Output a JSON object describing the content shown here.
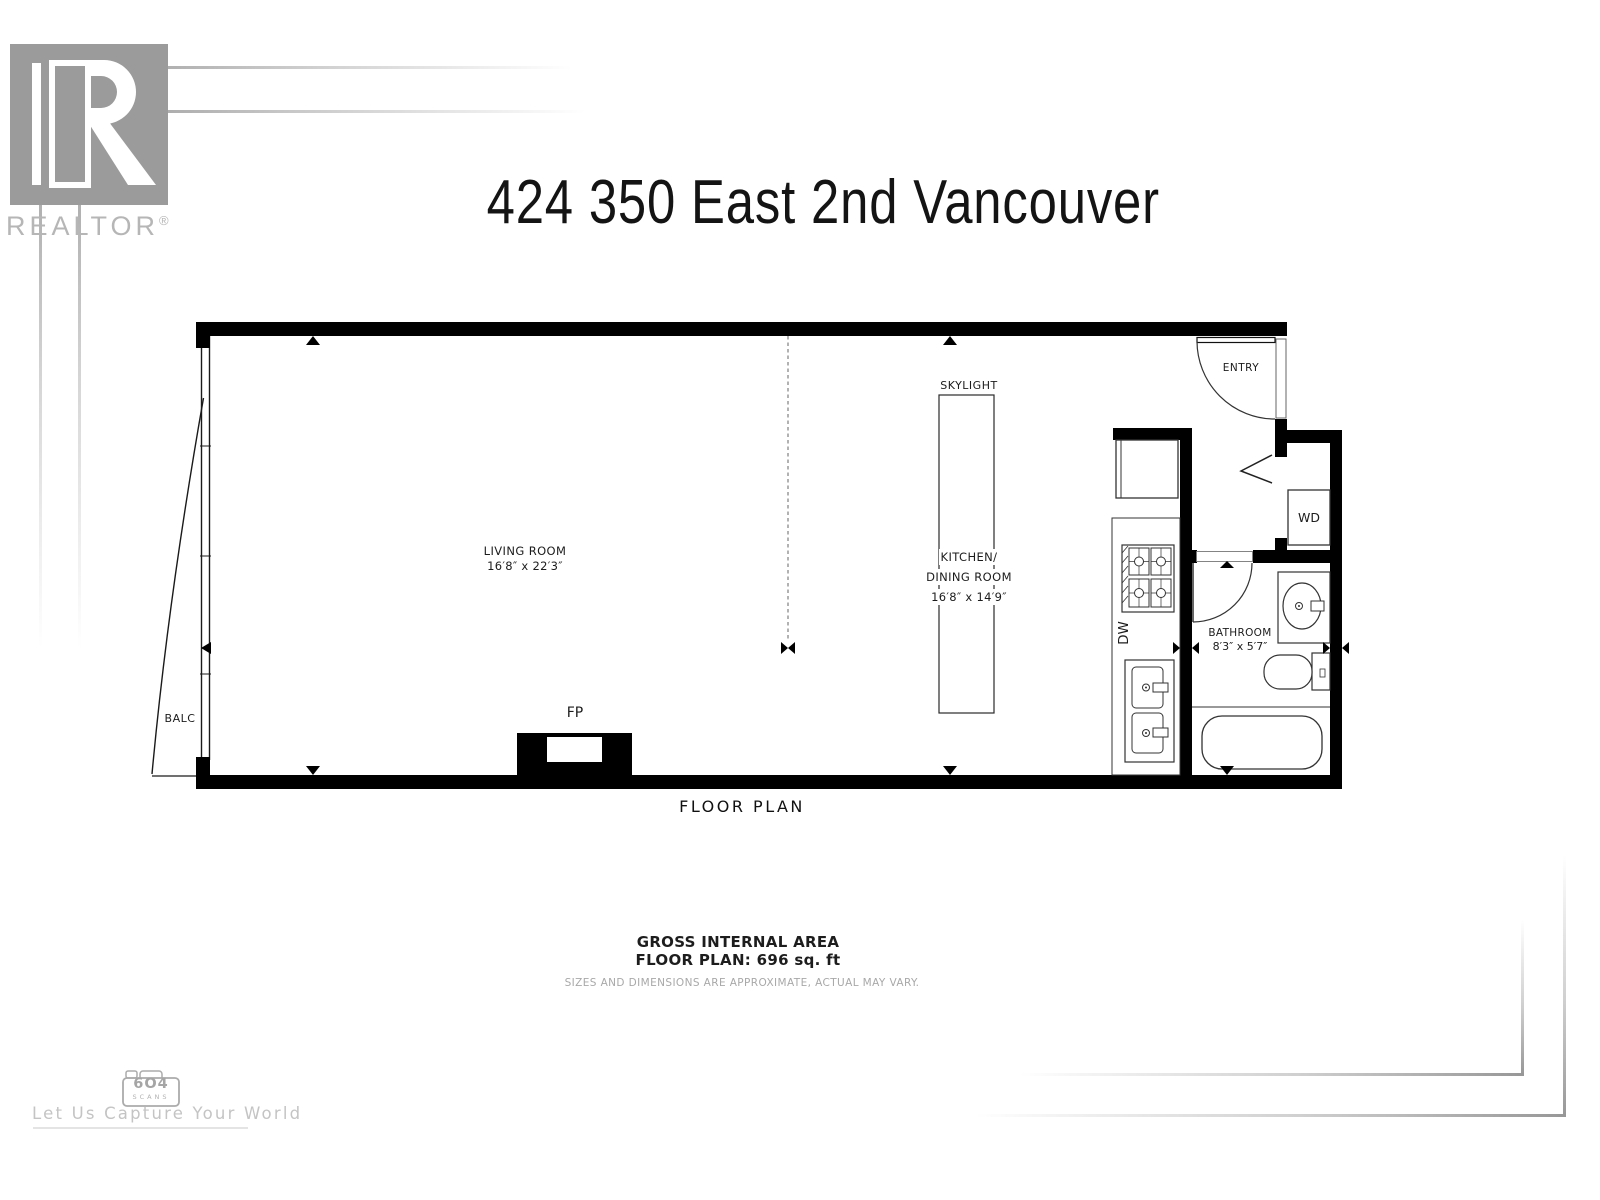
{
  "branding": {
    "realtor": "REALTOR",
    "registered_mark": "®"
  },
  "title": "424 350 East 2nd Vancouver",
  "plan": {
    "caption": "FLOOR PLAN",
    "labels": {
      "living_room": {
        "name": "LIVING ROOM",
        "dims": "16′8″ x 22′3″"
      },
      "kitchen_dining": {
        "name_line1": "KITCHEN/",
        "name_line2": "DINING ROOM",
        "dims": "16′8″ x 14′9″"
      },
      "bathroom": {
        "name": "BATHROOM",
        "dims": "8′3″ x 5′7″"
      },
      "entry": "ENTRY",
      "skylight": "SKYLIGHT",
      "balcony": "BALC",
      "fireplace": "FP",
      "washer_dryer": "WD",
      "dishwasher": "DW"
    }
  },
  "summary": {
    "area_heading": "GROSS INTERNAL AREA",
    "area_value": "FLOOR PLAN: 696 sq. ft",
    "disclaimer": "SIZES AND DIMENSIONS ARE APPROXIMATE, ACTUAL MAY VARY."
  },
  "footer": {
    "logo_number": "6O4",
    "logo_word": "SCANS",
    "tagline": "Let Us Capture Your World"
  },
  "colors": {
    "wall": "#000000",
    "label_text": "#1c1c1c",
    "muted_gray": "#a8a8a8",
    "brand_gray": "#9b9b9b"
  }
}
